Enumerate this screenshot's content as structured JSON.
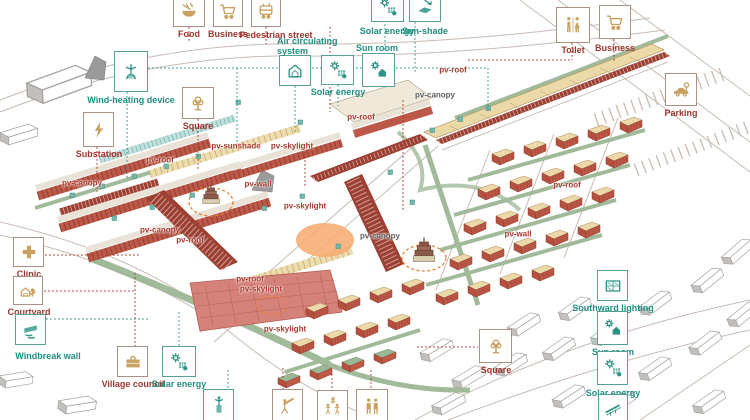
{
  "meta": {
    "description": "Axonometric village master-plan diagram with passive-energy and program callouts"
  },
  "palette": {
    "teal_label": "#1f8f80",
    "red_label": "#9c362c",
    "pv_red": "#a83a2e",
    "pv_gray": "#5f5f5f",
    "icon_tan": "#c9a160",
    "icon_teal": "#2f9488",
    "box_border_red": "#ab9183",
    "box_border_teal": "#55a095",
    "terracotta": "#bc5847",
    "roof_cream": "#ecd9a8",
    "canopy_red": "#9c4034",
    "big_roof_pink": "#d4827a",
    "sage_green": "#9cb795",
    "glass_teal": "#bfe0dc",
    "orange_dash": "#e8833a",
    "road_gray": "#c9bbb2"
  },
  "legend": [
    {
      "id": "food",
      "icon": "bowl",
      "group": "red",
      "x": 173,
      "y": -7,
      "w": 32,
      "h": 34,
      "label": "Food",
      "label_x": 167,
      "label_y": 29,
      "label_w": 44
    },
    {
      "id": "business-top",
      "icon": "cart",
      "group": "red",
      "x": 213,
      "y": -5,
      "w": 30,
      "h": 32,
      "label": "Business",
      "label_x": 199,
      "label_y": 29,
      "label_w": 58
    },
    {
      "id": "pedestrian-street",
      "icon": "tram",
      "group": "red",
      "x": 251,
      "y": -5,
      "w": 30,
      "h": 32,
      "label": "Pedestrian street",
      "label_x": 231,
      "label_y": 30,
      "label_w": 90
    },
    {
      "id": "solar-energy-top",
      "icon": "sun-panel",
      "group": "teal",
      "x": 371,
      "y": -8,
      "w": 33,
      "h": 30,
      "label": "Solar energy",
      "label_x": 352,
      "label_y": 26,
      "label_w": 70
    },
    {
      "id": "sun-shade",
      "icon": "tilt-panel",
      "group": "teal",
      "x": 409,
      "y": -8,
      "w": 32,
      "h": 30,
      "label": "Sun-shade",
      "label_x": 394,
      "label_y": 26,
      "label_w": 62
    },
    {
      "id": "toilet",
      "icon": "wc",
      "group": "red",
      "x": 556,
      "y": 7,
      "w": 34,
      "h": 36,
      "label": "Toilet",
      "label_x": 543,
      "label_y": 45,
      "label_w": 60
    },
    {
      "id": "business-right",
      "icon": "cart",
      "group": "red",
      "x": 599,
      "y": 5,
      "w": 32,
      "h": 34,
      "label": "Business",
      "label_x": 585,
      "label_y": 43,
      "label_w": 60
    },
    {
      "id": "parking",
      "icon": "car",
      "group": "red",
      "x": 665,
      "y": 73,
      "w": 32,
      "h": 33,
      "label": "Parking",
      "label_x": 651,
      "label_y": 108,
      "label_w": 60
    },
    {
      "id": "wind-heating-device",
      "icon": "turbine",
      "group": "teal",
      "x": 114,
      "y": 51,
      "w": 34,
      "h": 41,
      "label": "Wind-heating device",
      "label_x": 73,
      "label_y": 95,
      "label_w": 116
    },
    {
      "id": "substation",
      "icon": "bolt",
      "group": "red",
      "x": 83,
      "y": 112,
      "w": 31,
      "h": 35,
      "label": "Substation",
      "label_x": 68,
      "label_y": 149,
      "label_w": 62
    },
    {
      "id": "square-left",
      "icon": "tree",
      "group": "red",
      "x": 182,
      "y": 87,
      "w": 32,
      "h": 32,
      "label": "Square",
      "label_x": 168,
      "label_y": 121,
      "label_w": 60
    },
    {
      "id": "air-circulating-system",
      "icon": "house-air",
      "group": "teal",
      "x": 279,
      "y": 55,
      "w": 32,
      "h": 31,
      "label": "Air circulating\nsystem",
      "label_x": 277,
      "label_y": 36,
      "label_w": 90,
      "align": "left"
    },
    {
      "id": "solar-energy-mid",
      "icon": "sun-panel",
      "group": "teal",
      "x": 321,
      "y": 55,
      "w": 33,
      "h": 30,
      "label": "Solar energy",
      "label_x": 303,
      "label_y": 87,
      "label_w": 70
    },
    {
      "id": "sun-room-mid",
      "icon": "sun-house",
      "group": "teal",
      "x": 362,
      "y": 53,
      "w": 33,
      "h": 34,
      "label": "Sun room",
      "label_x": 349,
      "label_y": 43,
      "label_w": 56
    },
    {
      "id": "clinic",
      "icon": "cross",
      "group": "red",
      "x": 13,
      "y": 237,
      "w": 31,
      "h": 30,
      "label": "Clinic",
      "label_x": 0,
      "label_y": 269,
      "label_w": 58
    },
    {
      "id": "courtyard",
      "icon": "yard",
      "group": "red",
      "x": 13,
      "y": 276,
      "w": 30,
      "h": 29,
      "label": "Courtyard",
      "label_x": 0,
      "label_y": 307,
      "label_w": 58
    },
    {
      "id": "windbreak-wall",
      "icon": "wall-wind",
      "group": "teal",
      "x": 15,
      "y": 314,
      "w": 31,
      "h": 31,
      "label": "Windbreak wall",
      "label_x": 0,
      "label_y": 351,
      "label_w": 96
    },
    {
      "id": "village-council",
      "icon": "briefcase",
      "group": "red",
      "x": 117,
      "y": 346,
      "w": 31,
      "h": 31,
      "label": "Village council",
      "label_x": 94,
      "label_y": 379,
      "label_w": 78
    },
    {
      "id": "solar-energy-bottom",
      "icon": "sun-panel",
      "group": "teal",
      "x": 162,
      "y": 346,
      "w": 34,
      "h": 31,
      "label": "Solar energy",
      "label_x": 145,
      "label_y": 379,
      "label_w": 68
    },
    {
      "id": "square-bottom",
      "icon": "tree",
      "group": "red",
      "x": 479,
      "y": 329,
      "w": 33,
      "h": 34,
      "label": "Square",
      "label_x": 466,
      "label_y": 365,
      "label_w": 60
    },
    {
      "id": "southward-lighting",
      "icon": "window",
      "group": "teal",
      "x": 597,
      "y": 270,
      "w": 31,
      "h": 31,
      "label": "Southward lighting",
      "label_x": 563,
      "label_y": 303,
      "label_w": 100
    },
    {
      "id": "sun-room-right",
      "icon": "sun-house",
      "group": "teal",
      "x": 597,
      "y": 311,
      "w": 31,
      "h": 34,
      "label": "Sun room",
      "label_x": 582,
      "label_y": 347,
      "label_w": 62
    },
    {
      "id": "solar-energy-right",
      "icon": "sun-panel",
      "group": "teal",
      "x": 597,
      "y": 351,
      "w": 31,
      "h": 34,
      "label": "Solar energy",
      "label_x": 575,
      "label_y": 388,
      "label_w": 76
    },
    {
      "id": "solar-panel-right",
      "icon": "panel",
      "group": "teal",
      "x": 598,
      "y": 394,
      "w": 30,
      "h": 28,
      "label": ""
    },
    {
      "id": "device-bottom",
      "icon": "gadget",
      "group": "teal",
      "x": 203,
      "y": 389,
      "w": 31,
      "h": 33,
      "label": ""
    },
    {
      "id": "stargazing-bottom",
      "icon": "telescope",
      "group": "red",
      "x": 272,
      "y": 389,
      "w": 31,
      "h": 33,
      "label": ""
    },
    {
      "id": "children-bottom",
      "icon": "kids",
      "group": "red",
      "x": 317,
      "y": 390,
      "w": 31,
      "h": 32,
      "label": ""
    },
    {
      "id": "elderly-bottom",
      "icon": "elders",
      "group": "red",
      "x": 356,
      "y": 389,
      "w": 32,
      "h": 33,
      "label": ""
    }
  ],
  "map_labels": [
    {
      "text": "pv-roof",
      "x": 160,
      "y": 160,
      "color": "red"
    },
    {
      "text": "pv-sunshade",
      "x": 236,
      "y": 146,
      "color": "red"
    },
    {
      "text": "pv-skylight",
      "x": 292,
      "y": 146,
      "color": "red"
    },
    {
      "text": "pv-wall",
      "x": 258,
      "y": 184,
      "color": "red"
    },
    {
      "text": "pv-skylight",
      "x": 305,
      "y": 206,
      "color": "red"
    },
    {
      "text": "pv-canopy",
      "x": 82,
      "y": 183,
      "color": "red"
    },
    {
      "text": "pv-canopy",
      "x": 160,
      "y": 230,
      "color": "red"
    },
    {
      "text": "pv-roof",
      "x": 190,
      "y": 240,
      "color": "red"
    },
    {
      "text": "pv-roof",
      "x": 453,
      "y": 70,
      "color": "red"
    },
    {
      "text": "pv-canopy",
      "x": 435,
      "y": 95,
      "color": "gray"
    },
    {
      "text": "pv-roof",
      "x": 361,
      "y": 117,
      "color": "red"
    },
    {
      "text": "pv-canopy",
      "x": 380,
      "y": 236,
      "color": "gray"
    },
    {
      "text": "pv-roof",
      "x": 250,
      "y": 279,
      "color": "red"
    },
    {
      "text": "pv-skylight",
      "x": 261,
      "y": 289,
      "color": "red"
    },
    {
      "text": "pv-skylight",
      "x": 285,
      "y": 329,
      "color": "red"
    },
    {
      "text": "pv-roof",
      "x": 567,
      "y": 185,
      "color": "red"
    },
    {
      "text": "pv-wall",
      "x": 518,
      "y": 234,
      "color": "red"
    }
  ]
}
